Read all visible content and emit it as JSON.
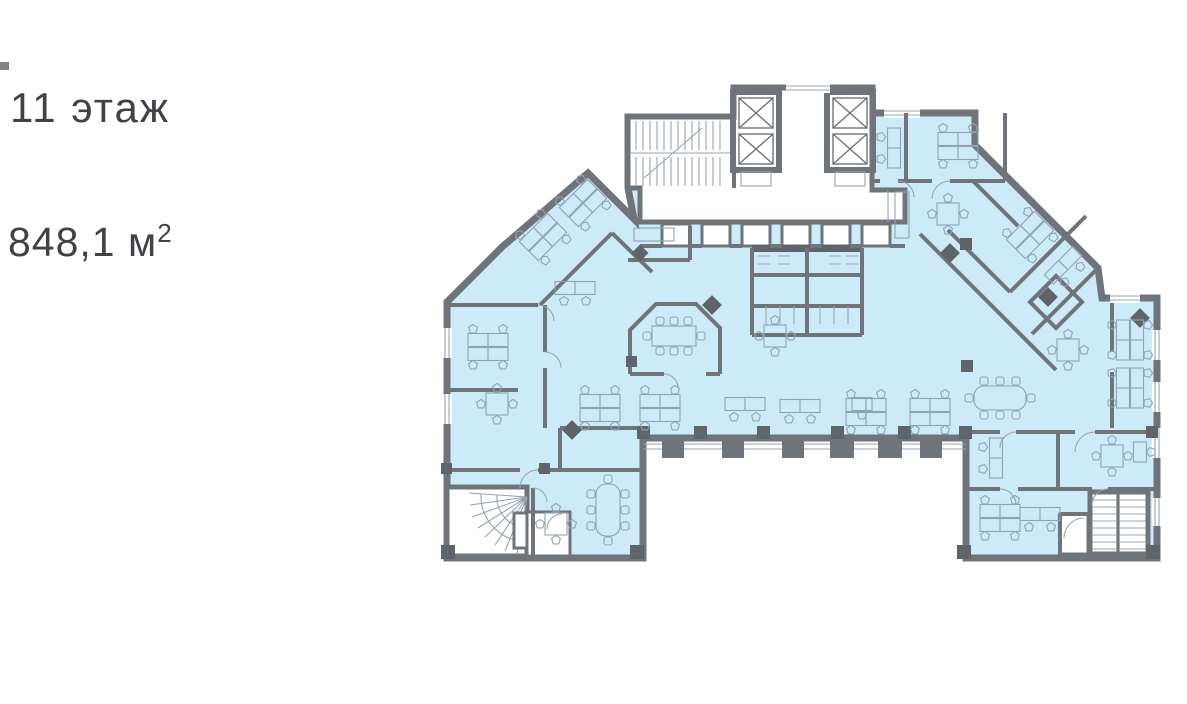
{
  "labels": {
    "floor": "11 этаж",
    "area_value": "848,1 м",
    "area_superscript": "2"
  },
  "plan": {
    "kind": "building-floor-plan",
    "floor_number": "11",
    "area_m2": "848,1",
    "colors": {
      "background": "#ffffff",
      "room_fill": "#cdeaf9",
      "wall": "#6e747a",
      "wall_dark": "#5f646a",
      "furniture_line": "#8fa3b3",
      "text": "#3f4247",
      "window_line": "#9aa4ab"
    }
  }
}
